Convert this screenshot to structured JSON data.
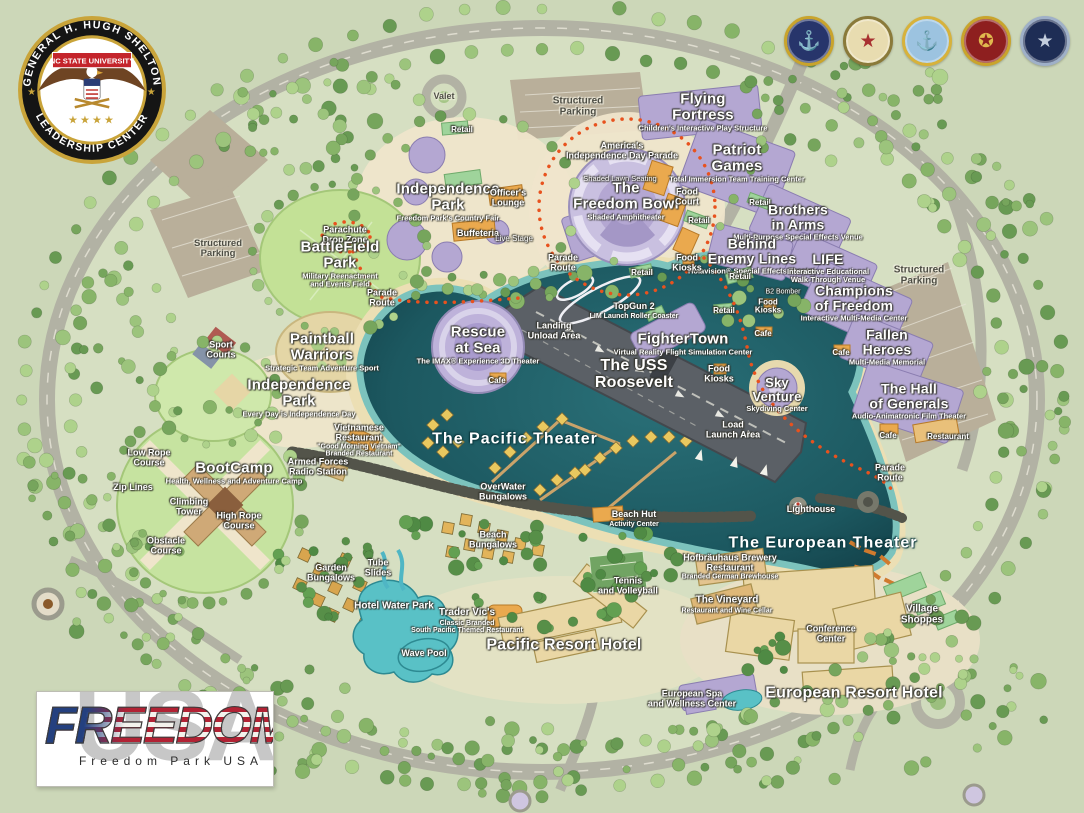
{
  "header": {
    "logo": {
      "ring_top": "GENERAL H. HUGH SHELTON",
      "ring_bottom": "LEADERSHIP CENTER",
      "banner": "NC STATE UNIVERSITY",
      "stars": "★★★★"
    },
    "seals": [
      {
        "name": "us-navy-seal",
        "bg": "#27356b",
        "ring": "#c9a42c",
        "glyph": "⚓",
        "color": "#d9b65b"
      },
      {
        "name": "us-army-seal",
        "bg": "#e8dcb0",
        "ring": "#8a7a3a",
        "glyph": "★",
        "color": "#a83030"
      },
      {
        "name": "us-coast-guard-seal",
        "bg": "#9cc3e0",
        "ring": "#d7b23b",
        "glyph": "⚓",
        "color": "#b5792f"
      },
      {
        "name": "us-marine-corps-seal",
        "bg": "#8e1f1f",
        "ring": "#c9a42c",
        "glyph": "✪",
        "color": "#e0b84e"
      },
      {
        "name": "us-air-force-seal",
        "bg": "#1e2d55",
        "ring": "#9fb0c8",
        "glyph": "★",
        "color": "#c4cede"
      }
    ]
  },
  "footer_logo": {
    "title": "FREEDOM",
    "backdrop": "USA",
    "subtitle": "Freedom Park USA"
  },
  "colors": {
    "land": "#ccd7b8",
    "park_land": "#d6dfc2",
    "road": "#b2b2a4",
    "parking": "#b9af9a",
    "water_deep": "#1c5860",
    "water_shallow": "#7cc3bd",
    "sand": "#ecdfb4",
    "attraction_purple": "#b4a7d2",
    "retail_green": "#9fd49b",
    "food_orange": "#eaa94e",
    "hotel_tan": "#ead7a5",
    "carrier_gray": "#5b6066",
    "parade_route": "#e8521e"
  },
  "map": {
    "labels": [
      {
        "text": "Valet",
        "x": 444,
        "y": 97,
        "size": 9,
        "v": "dark"
      },
      {
        "text": "Structured\nParking",
        "x": 578,
        "y": 107,
        "size": 10,
        "v": "dark"
      },
      {
        "text": "Structured\nParking",
        "x": 218,
        "y": 249,
        "size": 9.5,
        "v": "dark"
      },
      {
        "text": "Structured\nParking",
        "x": 919,
        "y": 276,
        "size": 10,
        "v": "dark"
      },
      {
        "text": "Retail",
        "x": 462,
        "y": 130,
        "size": 8,
        "v": "name"
      },
      {
        "text": "Flying\nFortress",
        "sub": "Children's Interactive Play Structure",
        "x": 703,
        "y": 112,
        "size": 15,
        "v": "major"
      },
      {
        "text": "Patriot\nGames",
        "sub": "Total Immersion Team Training Center",
        "x": 737,
        "y": 163,
        "size": 15,
        "v": "major"
      },
      {
        "text": "America's\nIndependence Day Parade",
        "x": 622,
        "y": 151,
        "size": 9,
        "v": "name"
      },
      {
        "text": "Shaded Lawn Seating",
        "x": 620,
        "y": 179,
        "size": 7.5,
        "v": "tiny"
      },
      {
        "text": "The\nFreedom Bowl",
        "sub": "Shaded Amphitheater",
        "x": 626,
        "y": 201,
        "size": 15,
        "v": "major"
      },
      {
        "text": "Food\nCourt",
        "x": 687,
        "y": 197,
        "size": 9,
        "v": "name"
      },
      {
        "text": "Retail",
        "x": 699,
        "y": 221,
        "size": 8,
        "v": "name"
      },
      {
        "text": "Retail",
        "x": 760,
        "y": 203,
        "size": 8,
        "v": "name"
      },
      {
        "text": "Brothers\nin Arms",
        "sub": "Multi-Purpose Special Effects Venue",
        "x": 798,
        "y": 222,
        "size": 14,
        "v": "major"
      },
      {
        "text": "Behind\nEnemy Lines",
        "sub": "Holavision® Special Effects Theater",
        "x": 752,
        "y": 256,
        "size": 14,
        "v": "major"
      },
      {
        "text": "LIFE",
        "sub": "Interactive Educational\nWalk-Through Venue",
        "x": 828,
        "y": 268,
        "size": 14,
        "v": "major"
      },
      {
        "text": "Champions\nof Freedom",
        "sub": "Interactive Multi-Media Center",
        "x": 854,
        "y": 303,
        "size": 14,
        "v": "major"
      },
      {
        "text": "Retail",
        "x": 740,
        "y": 277,
        "size": 8,
        "v": "name"
      },
      {
        "text": "B2 Bomber",
        "x": 783,
        "y": 292,
        "size": 7,
        "v": "tiny"
      },
      {
        "text": "Food\nKiosks",
        "x": 768,
        "y": 307,
        "size": 8,
        "v": "name"
      },
      {
        "text": "Retail",
        "x": 724,
        "y": 311,
        "size": 8,
        "v": "name"
      },
      {
        "text": "Food\nKiosks",
        "x": 687,
        "y": 263,
        "size": 9,
        "v": "name"
      },
      {
        "text": "Retail",
        "x": 642,
        "y": 273,
        "size": 8,
        "v": "name"
      },
      {
        "text": "Parade\nRoute",
        "x": 563,
        "y": 263,
        "size": 9,
        "v": "name"
      },
      {
        "text": "TopGun 2",
        "sub": "LIM Launch Roller Coaster",
        "x": 634,
        "y": 311,
        "size": 9,
        "v": "name"
      },
      {
        "text": "Cafe",
        "x": 763,
        "y": 334,
        "size": 8,
        "v": "name"
      },
      {
        "text": "Fallen\nHeroes",
        "sub": "Multi-Media Memorial",
        "x": 887,
        "y": 347,
        "size": 14,
        "v": "major"
      },
      {
        "text": "Cafe",
        "x": 841,
        "y": 353,
        "size": 8,
        "v": "name"
      },
      {
        "text": "The Hall\nof Generals",
        "sub": "Audio-Animatronic Film Theater",
        "x": 909,
        "y": 401,
        "size": 14,
        "v": "major"
      },
      {
        "text": "Cafe",
        "x": 888,
        "y": 436,
        "size": 8,
        "v": "name"
      },
      {
        "text": "Restaurant",
        "x": 948,
        "y": 437,
        "size": 8,
        "v": "name"
      },
      {
        "text": "Sky\nVenture",
        "sub": "Skydiving Center",
        "x": 777,
        "y": 394,
        "size": 13,
        "v": "major"
      },
      {
        "text": "Food\nKiosks",
        "x": 719,
        "y": 374,
        "size": 9,
        "v": "name"
      },
      {
        "text": "FighterTown",
        "sub": "Virtual Reality Flight Simulation Center",
        "x": 683,
        "y": 344,
        "size": 15,
        "v": "major"
      },
      {
        "text": "The USS\nRoosevelt",
        "x": 634,
        "y": 375,
        "size": 16,
        "v": "major"
      },
      {
        "text": "Landing\nUnload Area",
        "x": 554,
        "y": 331,
        "size": 9,
        "v": "name"
      },
      {
        "text": "Load\nLaunch Area",
        "x": 733,
        "y": 430,
        "size": 9,
        "v": "name"
      },
      {
        "text": "Rescue\nat Sea",
        "sub": "The IMAX® Experience 3D Theater",
        "x": 478,
        "y": 345,
        "size": 15,
        "v": "major"
      },
      {
        "text": "Cafe",
        "x": 497,
        "y": 381,
        "size": 8,
        "v": "name"
      },
      {
        "text": "Parachute\nDrop Zone",
        "x": 345,
        "y": 235,
        "size": 9,
        "v": "name"
      },
      {
        "text": "BattleField\nPark",
        "sub": "Military Reenactment\nand Events Field",
        "x": 340,
        "y": 264,
        "size": 15,
        "v": "major"
      },
      {
        "text": "Parade\nRoute",
        "x": 382,
        "y": 298,
        "size": 9,
        "v": "name"
      },
      {
        "text": "Sport\nCourts",
        "x": 221,
        "y": 350,
        "size": 9,
        "v": "name"
      },
      {
        "text": "Paintball\nWarriors",
        "sub": "Strategic Team Adventure Sport",
        "x": 322,
        "y": 352,
        "size": 15,
        "v": "major"
      },
      {
        "text": "Independence\nPark",
        "sub": "Freedom Park's Country Fair",
        "x": 448,
        "y": 202,
        "size": 15,
        "v": "major"
      },
      {
        "text": "Officer's\nLounge",
        "x": 508,
        "y": 198,
        "size": 9,
        "v": "name"
      },
      {
        "text": "Buffeteria",
        "x": 478,
        "y": 234,
        "size": 9,
        "v": "name"
      },
      {
        "text": "Live Stage",
        "x": 514,
        "y": 239,
        "size": 8,
        "v": "tiny"
      },
      {
        "text": "Independence\nPark",
        "sub": "Every Day is Independence Day",
        "x": 299,
        "y": 398,
        "size": 15,
        "v": "major"
      },
      {
        "text": "Low Rope\nCourse",
        "x": 149,
        "y": 458,
        "size": 9,
        "v": "name"
      },
      {
        "text": "Zip Lines",
        "x": 133,
        "y": 488,
        "size": 9,
        "v": "name"
      },
      {
        "text": "BootCamp",
        "sub": "Health, Wellness and Adventure Camp",
        "x": 234,
        "y": 473,
        "size": 15,
        "v": "major"
      },
      {
        "text": "Climbing\nTower",
        "x": 189,
        "y": 507,
        "size": 9,
        "v": "name"
      },
      {
        "text": "High Rope\nCourse",
        "x": 239,
        "y": 521,
        "size": 9,
        "v": "name"
      },
      {
        "text": "Obstacle\nCourse",
        "x": 166,
        "y": 546,
        "size": 9,
        "v": "name"
      },
      {
        "text": "Armed Forces\nRadio Station",
        "x": 318,
        "y": 467,
        "size": 9,
        "v": "name"
      },
      {
        "text": "Vietnamese\nRestaurant",
        "sub": "\"Good Morning Vietnam\"\nBranded Restaurant",
        "x": 359,
        "y": 441,
        "size": 9,
        "v": "name"
      },
      {
        "text": "The Pacific Theater",
        "x": 515,
        "y": 440,
        "size": 16,
        "v": "water"
      },
      {
        "text": "OverWater\nBungalows",
        "x": 503,
        "y": 492,
        "size": 9,
        "v": "name"
      },
      {
        "text": "Beach Hut",
        "sub": "Activity Center",
        "x": 634,
        "y": 519,
        "size": 9,
        "v": "name"
      },
      {
        "text": "Beach\nBungalows",
        "x": 493,
        "y": 540,
        "size": 9,
        "v": "name"
      },
      {
        "text": "Tennis\nand Volleyball",
        "x": 628,
        "y": 586,
        "size": 9,
        "v": "name"
      },
      {
        "text": "Trader Vic's",
        "sub": "Classic Branded\nSouth Pacific Themed Restaurant",
        "x": 467,
        "y": 621,
        "size": 10,
        "v": "name"
      },
      {
        "text": "Pacific Resort Hotel",
        "x": 564,
        "y": 646,
        "size": 16,
        "v": "major"
      },
      {
        "text": "Garden\nBungalows",
        "x": 331,
        "y": 573,
        "size": 9,
        "v": "name"
      },
      {
        "text": "Tube\nSlides",
        "x": 378,
        "y": 568,
        "size": 9,
        "v": "name"
      },
      {
        "text": "Hotel Water Park",
        "x": 394,
        "y": 607,
        "size": 10,
        "v": "name"
      },
      {
        "text": "Wave Pool",
        "x": 424,
        "y": 654,
        "size": 9,
        "v": "name"
      },
      {
        "text": "Lighthouse",
        "x": 811,
        "y": 510,
        "size": 9,
        "v": "name"
      },
      {
        "text": "The European Theater",
        "x": 823,
        "y": 544,
        "size": 16,
        "v": "water"
      },
      {
        "text": "Hofbräuhaus Brewery\nRestaurant",
        "sub": "Branded German Brewhouse",
        "x": 730,
        "y": 567,
        "size": 9,
        "v": "name"
      },
      {
        "text": "The Vineyard",
        "sub": "Restaurant and Wine Cellar",
        "x": 727,
        "y": 605,
        "size": 10,
        "v": "name"
      },
      {
        "text": "Conference\nCenter",
        "x": 831,
        "y": 634,
        "size": 9,
        "v": "name"
      },
      {
        "text": "Village\nShoppes",
        "x": 922,
        "y": 615,
        "size": 10,
        "v": "name"
      },
      {
        "text": "European Spa\nand Wellness Center",
        "x": 692,
        "y": 699,
        "size": 9,
        "v": "name"
      },
      {
        "text": "European Resort Hotel",
        "x": 854,
        "y": 694,
        "size": 16,
        "v": "major"
      },
      {
        "text": "Parade\nRoute",
        "x": 890,
        "y": 473,
        "size": 9,
        "v": "name"
      }
    ]
  }
}
